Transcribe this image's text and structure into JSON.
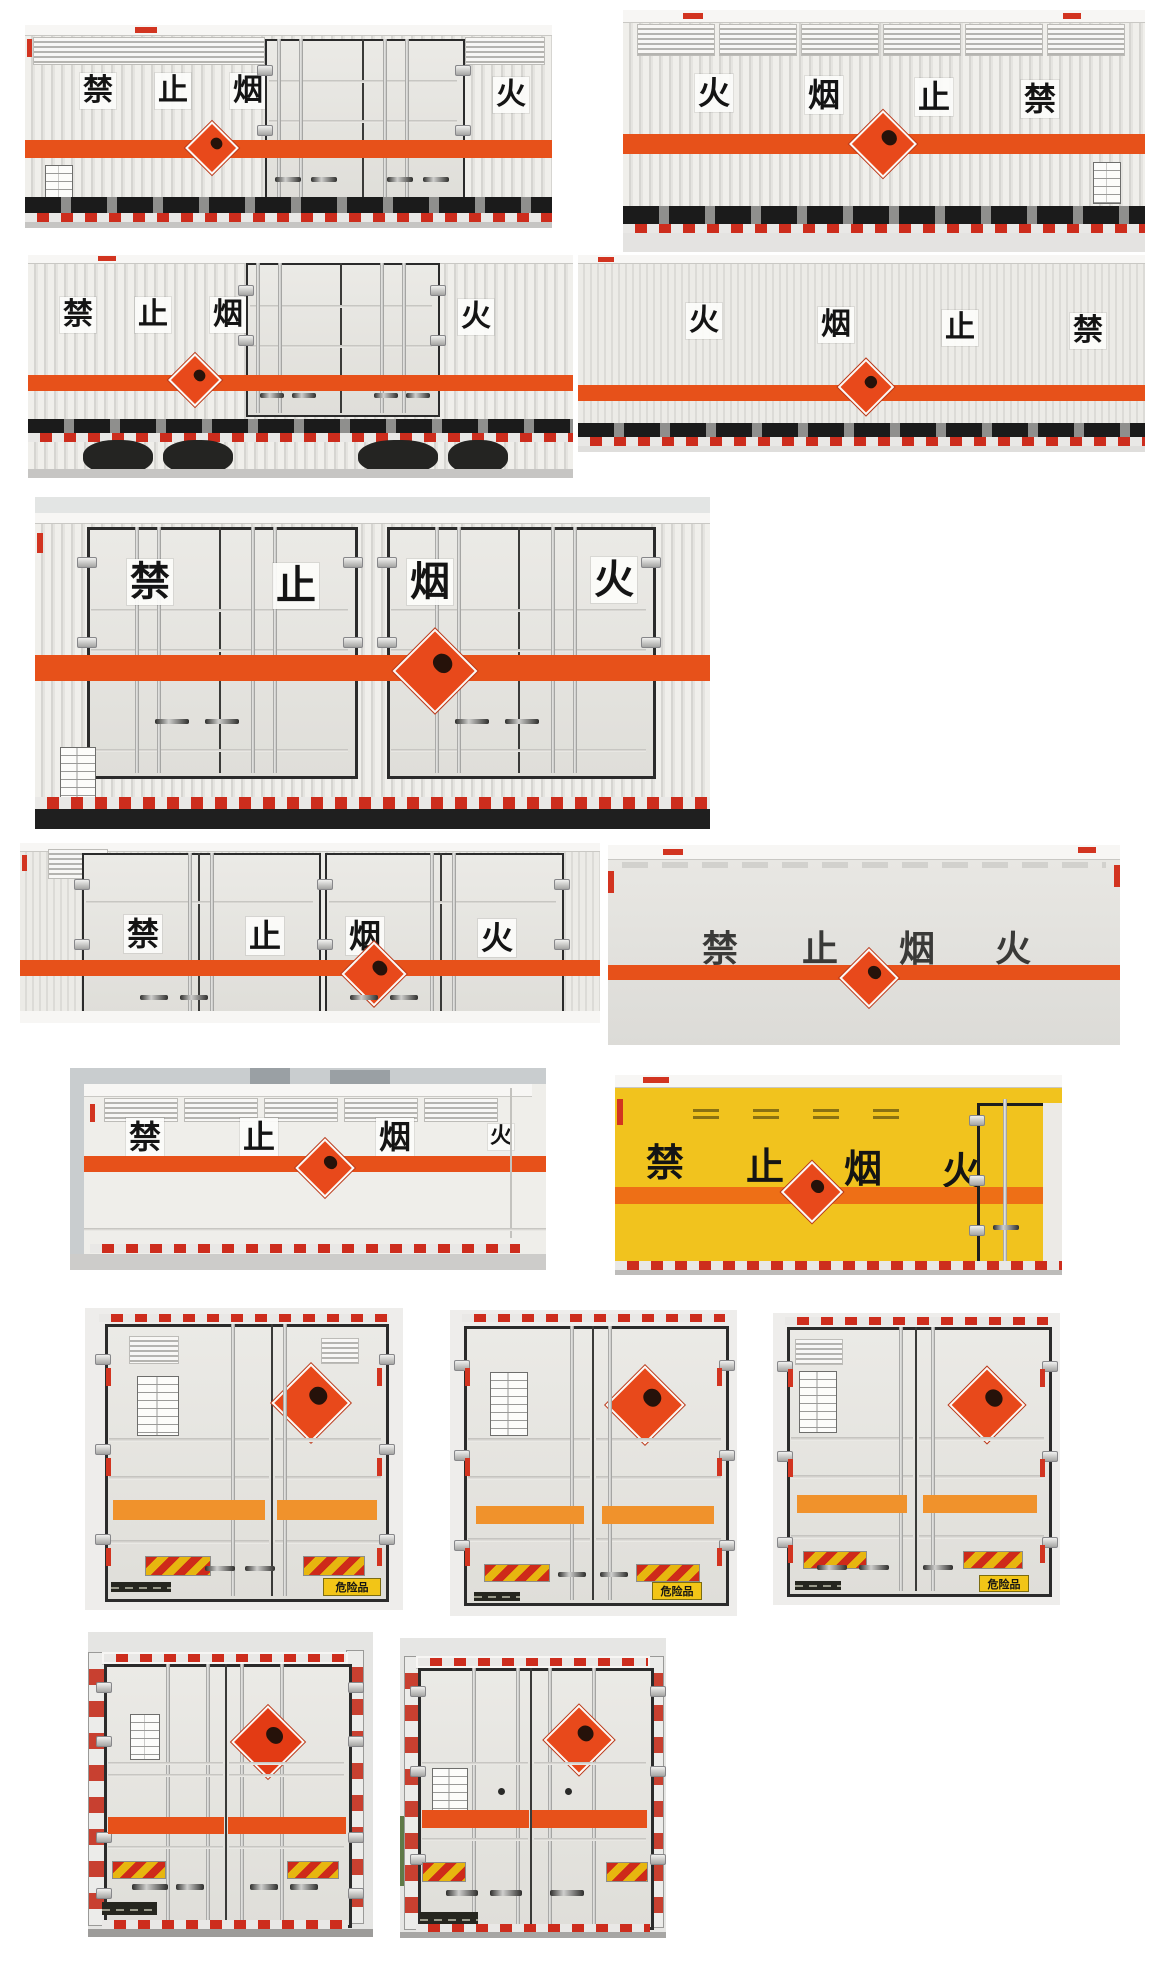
{
  "labels": {
    "dangerous_goods": "危险品"
  },
  "colors": {
    "stripe_red_orange": "#e7511a",
    "stripe_orange": "#f0922c",
    "hazard_diamond": "#e8491b",
    "box_yellow": "#f1c31e",
    "dangerous_plate_yellow": "#f2c517",
    "reflector_red": "#d23420"
  },
  "photos": {
    "p01": {
      "view": "box-van-left-side",
      "chars": [
        "禁",
        "止",
        "烟",
        "火"
      ]
    },
    "p02": {
      "view": "box-van-right-side",
      "chars": [
        "火",
        "烟",
        "止",
        "禁"
      ]
    },
    "p03": {
      "view": "box-van-left-side",
      "chars": [
        "禁",
        "止",
        "烟",
        "火"
      ]
    },
    "p04": {
      "view": "box-van-right-side",
      "chars": [
        "火",
        "烟",
        "止",
        "禁"
      ]
    },
    "p05": {
      "view": "box-van-left-side-doors",
      "chars": [
        "禁",
        "止",
        "烟",
        "火"
      ]
    },
    "p06": {
      "view": "box-van-left-side-doors",
      "chars": [
        "禁",
        "止",
        "烟",
        "火"
      ]
    },
    "p07": {
      "view": "box-van-smooth-side",
      "chars": [
        "禁",
        "止",
        "烟",
        "火"
      ]
    },
    "p08": {
      "view": "box-van-left-side",
      "chars": [
        "禁",
        "止",
        "烟",
        "火"
      ]
    },
    "p09": {
      "view": "yellow-box-van-side",
      "chars": [
        "禁",
        "止",
        "烟",
        "火"
      ]
    },
    "p10": {
      "view": "box-van-rear-doors"
    },
    "p11": {
      "view": "box-van-rear-doors"
    },
    "p12": {
      "view": "box-van-rear-doors"
    },
    "p13": {
      "view": "box-van-rear-doors"
    },
    "p14": {
      "view": "box-van-rear-doors"
    }
  }
}
